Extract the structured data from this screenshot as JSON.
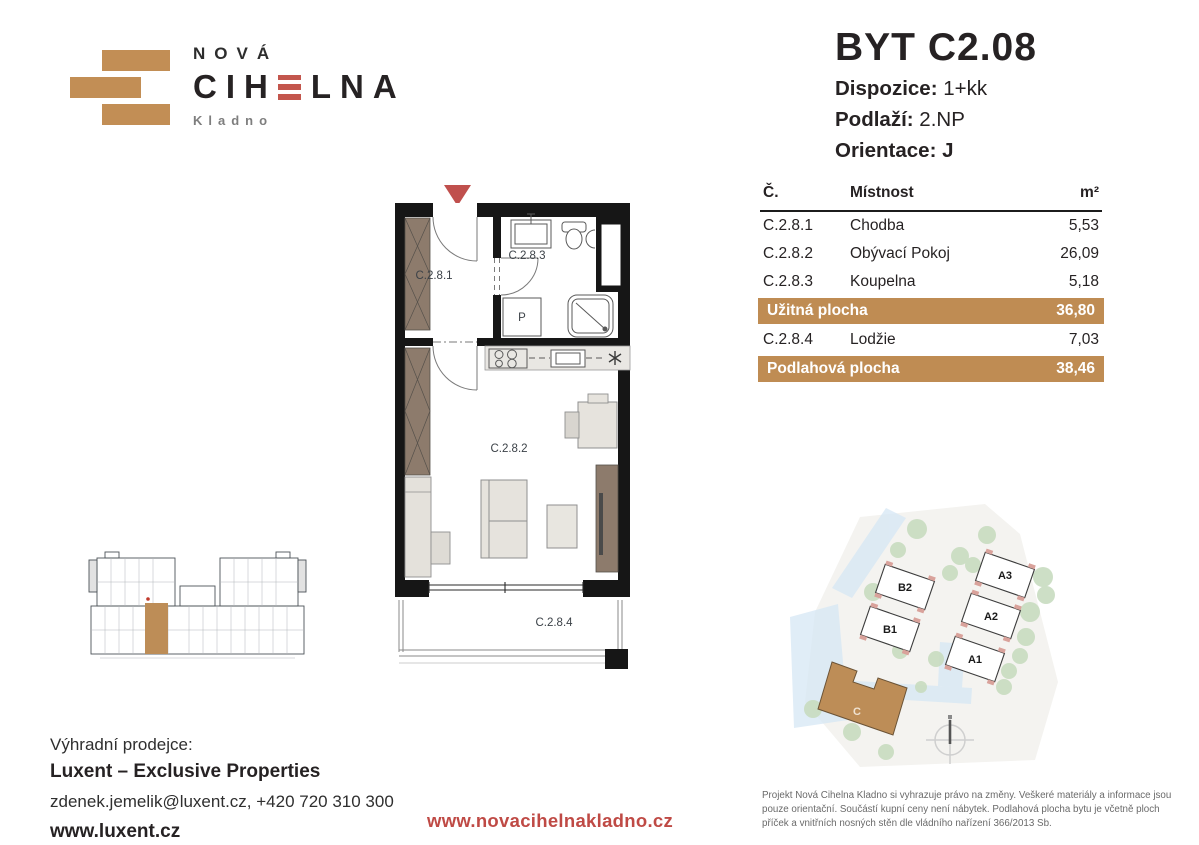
{
  "logo": {
    "line1": "NOVÁ",
    "brand_pre": "CIH",
    "brand_post": "LNA",
    "city": "Kladno"
  },
  "header": {
    "title": "BYT C2.08",
    "dispozice_label": "Dispozice:",
    "dispozice_value": "1+kk",
    "podlazi_label": "Podlaží:",
    "podlazi_value": "2.NP",
    "orientace_label": "Orientace:",
    "orientace_value": "J"
  },
  "table": {
    "col_num": "Č.",
    "col_room": "Místnost",
    "col_area": "m²",
    "rows": [
      {
        "num": "C.2.8.1",
        "room": "Chodba",
        "area": "5,53"
      },
      {
        "num": "C.2.8.2",
        "room": "Obývací Pokoj",
        "area": "26,09"
      },
      {
        "num": "C.2.8.3",
        "room": "Koupelna",
        "area": "5,18"
      }
    ],
    "usable_label": "Užitná plocha",
    "usable_value": "36,80",
    "loggia_row": {
      "num": "C.2.8.4",
      "room": "Lodžie",
      "area": "7,03"
    },
    "total_label": "Podlahová plocha",
    "total_value": "38,46"
  },
  "floorplan": {
    "labels": {
      "hall": "C.2.8.1",
      "bath": "C.2.8.3",
      "living": "C.2.8.2",
      "loggia": "C.2.8.4",
      "washer": "P"
    }
  },
  "siteplan": {
    "buildings": {
      "b2": "B2",
      "b1": "B1",
      "a3": "A3",
      "a2": "A2",
      "a1": "A1",
      "c": "C"
    }
  },
  "footer": {
    "seller_label": "Výhradní prodejce:",
    "seller_name": "Luxent – Exclusive Properties",
    "contact": "zdenek.jemelik@luxent.cz, +420 720 310 300",
    "web": "www.luxent.cz",
    "project_web": "www.novacihelnakladno.cz",
    "disclaimer": "Projekt Nová Cihelna Kladno si vyhrazuje právo na změny. Veškeré materiály a informace jsou pouze orientační. Součástí kupní ceny není nábytek. Podlahová plocha bytu je včetně ploch příček a vnitřních nosných stěn dle vládního nařízení 366/2013 Sb."
  },
  "colors": {
    "accent_tan": "#bf8c53",
    "accent_red": "#c0504a",
    "wall_black": "#161616"
  }
}
